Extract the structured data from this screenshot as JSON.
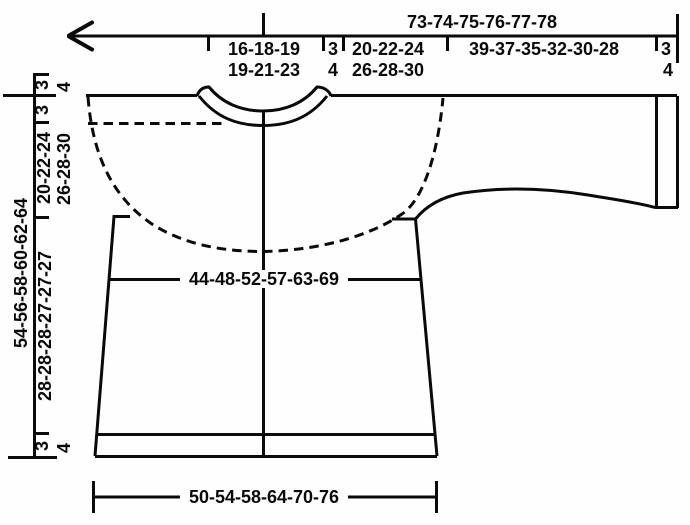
{
  "diagram": {
    "kind": "knitting-pattern-garment-schematic",
    "line_color": "#0a0a0a",
    "background_color": "#fefefe",
    "top_ruler": {
      "total_width": "73-74-75-76-77-78",
      "segments": [
        {
          "line1": "16-18-19",
          "line2": "19-21-23"
        },
        {
          "line1": "3",
          "line2": "4"
        },
        {
          "line1": "20-22-24",
          "line2": "26-28-30"
        },
        {
          "line1": "39-37-35-32-30-28",
          "line2": ""
        },
        {
          "line1": "3",
          "line2": "4"
        }
      ]
    },
    "left_ruler": {
      "top_edge_a": "3",
      "top_edge_b": "4",
      "neck_depth": "3",
      "yoke_depth_a": "20-22-24",
      "yoke_depth_b": "26-28-30",
      "total_length": "54-56-58-60-62-64",
      "body_length": "28-28-28-27-27-27",
      "hem_edge_a": "3",
      "hem_edge_b": "4"
    },
    "body": {
      "chest_width": "44-48-52-57-63-69",
      "bottom_width": "50-54-58-64-70-76"
    }
  }
}
